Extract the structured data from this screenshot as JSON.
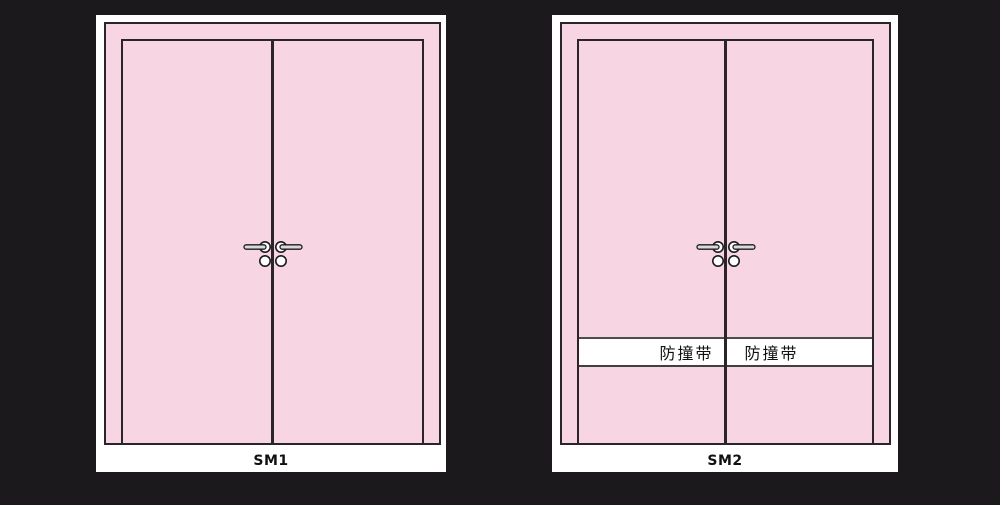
{
  "scene": {
    "background_color": "#1c191c",
    "description": "Two pink double-door elevation diagrams on white cards"
  },
  "doors": [
    {
      "label": "SM1",
      "leaf_count": 2,
      "bump_strip": null
    },
    {
      "label": "SM2",
      "leaf_count": 2,
      "bump_strip": {
        "left_label": "防撞带",
        "right_label": "防撞带"
      }
    }
  ],
  "colors": {
    "background": "#1c191c",
    "card": "#ffffff",
    "panel_pink": "#f8d5e2",
    "outline": "#2b242b",
    "handle_bar_fill": "#d9d9d9",
    "bump_strip_background": "#ffffff",
    "bump_strip_border": "#4d4d4d",
    "label_text": "#111111"
  },
  "icons": [
    {
      "name": "lever-handle-icon"
    },
    {
      "name": "lock-cylinder-icon"
    }
  ]
}
